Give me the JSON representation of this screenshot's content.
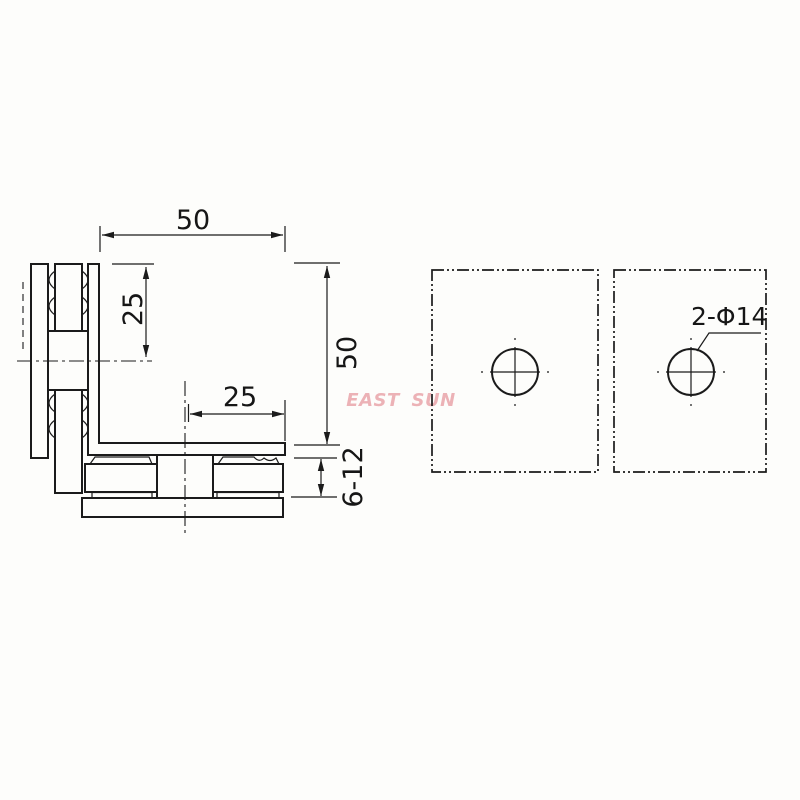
{
  "watermark": {
    "text": "EAST SUN",
    "color": "#e2858d"
  },
  "section_view": {
    "dim_top_width": "50",
    "dim_hole_offset_vertical": "25",
    "dim_height": "50",
    "dim_hole_offset_horizontal": "25",
    "dim_glass_thickness": "6-12"
  },
  "face_view": {
    "hole_label": "2-Φ14"
  },
  "colors": {
    "line": "#1b1b1b",
    "background": "#fdfdfb",
    "watermark": "#e2858d"
  }
}
